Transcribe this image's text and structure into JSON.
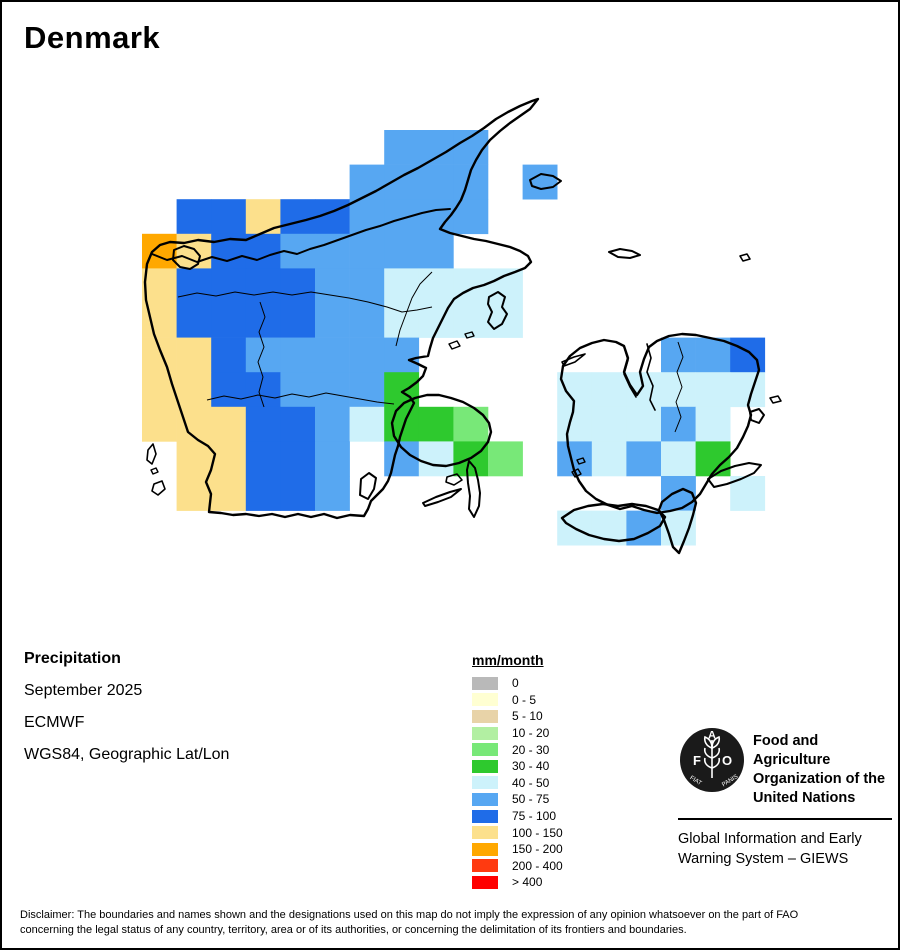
{
  "page": {
    "title": "Denmark"
  },
  "info": {
    "layer": "Precipitation",
    "period": "September 2025",
    "source": "ECMWF",
    "projection": "WGS84, Geographic Lat/Lon"
  },
  "legend": {
    "title": "mm/month",
    "items": [
      {
        "label": "0",
        "color": "#b9b9b9"
      },
      {
        "label": "0 - 5",
        "color": "#ffffd2"
      },
      {
        "label": "5 - 10",
        "color": "#e8d3a8"
      },
      {
        "label": "10 - 20",
        "color": "#b2efa2"
      },
      {
        "label": "20 - 30",
        "color": "#78e878"
      },
      {
        "label": "30 - 40",
        "color": "#2ec92e"
      },
      {
        "label": "40 - 50",
        "color": "#cdf2fb"
      },
      {
        "label": "50 - 75",
        "color": "#57a7f2"
      },
      {
        "label": "75 - 100",
        "color": "#1f6ce8"
      },
      {
        "label": "100 - 150",
        "color": "#fce08c"
      },
      {
        "label": "150 - 200",
        "color": "#ffa800"
      },
      {
        "label": "200 - 400",
        "color": "#ff3a10"
      },
      {
        "label": "> 400",
        "color": "#ff0000"
      }
    ]
  },
  "chart_data": {
    "type": "heatmap",
    "title": "Denmark precipitation, September 2025 (ECMWF), mm/month",
    "note": "grid cells: [col,row,value-class]; cell origin x0,y0 px, square cells"
  },
  "map": {
    "grid": {
      "x0": 140,
      "y0": 128,
      "cell": 34.6,
      "cells": [
        [
          7,
          0,
          "50 - 75"
        ],
        [
          8,
          0,
          "50 - 75"
        ],
        [
          9,
          0,
          "50 - 75"
        ],
        [
          6,
          1,
          "50 - 75"
        ],
        [
          7,
          1,
          "50 - 75"
        ],
        [
          8,
          1,
          "50 - 75"
        ],
        [
          9,
          1,
          "50 - 75"
        ],
        [
          11,
          1,
          "50 - 75"
        ],
        [
          1,
          2,
          "75 - 100"
        ],
        [
          2,
          2,
          "75 - 100"
        ],
        [
          3,
          2,
          "100 - 150"
        ],
        [
          4,
          2,
          "75 - 100"
        ],
        [
          5,
          2,
          "75 - 100"
        ],
        [
          6,
          2,
          "50 - 75"
        ],
        [
          7,
          2,
          "50 - 75"
        ],
        [
          8,
          2,
          "50 - 75"
        ],
        [
          9,
          2,
          "50 - 75"
        ],
        [
          0,
          3,
          "150 - 200"
        ],
        [
          1,
          3,
          "100 - 150"
        ],
        [
          2,
          3,
          "75 - 100"
        ],
        [
          3,
          3,
          "75 - 100"
        ],
        [
          4,
          3,
          "50 - 75"
        ],
        [
          5,
          3,
          "50 - 75"
        ],
        [
          6,
          3,
          "50 - 75"
        ],
        [
          7,
          3,
          "50 - 75"
        ],
        [
          8,
          3,
          "50 - 75"
        ],
        [
          0,
          4,
          "100 - 150"
        ],
        [
          1,
          4,
          "75 - 100"
        ],
        [
          2,
          4,
          "75 - 100"
        ],
        [
          3,
          4,
          "75 - 100"
        ],
        [
          4,
          4,
          "75 - 100"
        ],
        [
          5,
          4,
          "50 - 75"
        ],
        [
          6,
          4,
          "50 - 75"
        ],
        [
          7,
          4,
          "40 - 50"
        ],
        [
          8,
          4,
          "40 - 50"
        ],
        [
          9,
          4,
          "40 - 50"
        ],
        [
          10,
          4,
          "40 - 50"
        ],
        [
          0,
          5,
          "100 - 150"
        ],
        [
          1,
          5,
          "75 - 100"
        ],
        [
          2,
          5,
          "75 - 100"
        ],
        [
          3,
          5,
          "75 - 100"
        ],
        [
          4,
          5,
          "75 - 100"
        ],
        [
          5,
          5,
          "50 - 75"
        ],
        [
          6,
          5,
          "50 - 75"
        ],
        [
          7,
          5,
          "40 - 50"
        ],
        [
          8,
          5,
          "40 - 50"
        ],
        [
          9,
          5,
          "40 - 50"
        ],
        [
          10,
          5,
          "40 - 50"
        ],
        [
          0,
          6,
          "100 - 150"
        ],
        [
          1,
          6,
          "100 - 150"
        ],
        [
          2,
          6,
          "75 - 100"
        ],
        [
          3,
          6,
          "50 - 75"
        ],
        [
          4,
          6,
          "50 - 75"
        ],
        [
          5,
          6,
          "50 - 75"
        ],
        [
          6,
          6,
          "50 - 75"
        ],
        [
          7,
          6,
          "50 - 75"
        ],
        [
          15,
          6,
          "50 - 75"
        ],
        [
          16,
          6,
          "50 - 75"
        ],
        [
          17,
          6,
          "75 - 100"
        ],
        [
          0,
          7,
          "100 - 150"
        ],
        [
          1,
          7,
          "100 - 150"
        ],
        [
          2,
          7,
          "75 - 100"
        ],
        [
          3,
          7,
          "75 - 100"
        ],
        [
          4,
          7,
          "50 - 75"
        ],
        [
          5,
          7,
          "50 - 75"
        ],
        [
          6,
          7,
          "50 - 75"
        ],
        [
          7,
          7,
          "30 - 40"
        ],
        [
          12,
          7,
          "40 - 50"
        ],
        [
          13,
          7,
          "40 - 50"
        ],
        [
          14,
          7,
          "40 - 50"
        ],
        [
          15,
          7,
          "40 - 50"
        ],
        [
          16,
          7,
          "40 - 50"
        ],
        [
          17,
          7,
          "40 - 50"
        ],
        [
          0,
          8,
          "100 - 150"
        ],
        [
          1,
          8,
          "100 - 150"
        ],
        [
          2,
          8,
          "100 - 150"
        ],
        [
          3,
          8,
          "75 - 100"
        ],
        [
          4,
          8,
          "75 - 100"
        ],
        [
          5,
          8,
          "50 - 75"
        ],
        [
          6,
          8,
          "40 - 50"
        ],
        [
          7,
          8,
          "30 - 40"
        ],
        [
          8,
          8,
          "30 - 40"
        ],
        [
          9,
          8,
          "20 - 30"
        ],
        [
          12,
          8,
          "40 - 50"
        ],
        [
          13,
          8,
          "40 - 50"
        ],
        [
          14,
          8,
          "40 - 50"
        ],
        [
          15,
          8,
          "50 - 75"
        ],
        [
          16,
          8,
          "40 - 50"
        ],
        [
          1,
          9,
          "100 - 150"
        ],
        [
          2,
          9,
          "100 - 150"
        ],
        [
          3,
          9,
          "75 - 100"
        ],
        [
          4,
          9,
          "75 - 100"
        ],
        [
          5,
          9,
          "50 - 75"
        ],
        [
          7,
          9,
          "50 - 75"
        ],
        [
          8,
          9,
          "40 - 50"
        ],
        [
          9,
          9,
          "30 - 40"
        ],
        [
          10,
          9,
          "20 - 30"
        ],
        [
          12,
          9,
          "50 - 75"
        ],
        [
          13,
          9,
          "40 - 50"
        ],
        [
          14,
          9,
          "50 - 75"
        ],
        [
          15,
          9,
          "40 - 50"
        ],
        [
          16,
          9,
          "30 - 40"
        ],
        [
          1,
          10,
          "100 - 150"
        ],
        [
          2,
          10,
          "100 - 150"
        ],
        [
          3,
          10,
          "75 - 100"
        ],
        [
          4,
          10,
          "75 - 100"
        ],
        [
          5,
          10,
          "50 - 75"
        ],
        [
          15,
          10,
          "50 - 75"
        ],
        [
          17,
          10,
          "40 - 50"
        ],
        [
          12,
          11,
          "40 - 50"
        ],
        [
          13,
          11,
          "40 - 50"
        ],
        [
          14,
          11,
          "50 - 75"
        ],
        [
          15,
          11,
          "40 - 50"
        ]
      ]
    }
  },
  "footer": {
    "logo_text_f": "F",
    "logo_text_a": "A",
    "logo_text_o": "O",
    "logo_motto_left": "FIAT",
    "logo_motto_right": "PANIS",
    "org_lines": [
      "Food and Agriculture",
      "Organization of the",
      "United Nations"
    ],
    "giews_lines": [
      "Global Information and Early",
      "Warning System – GIEWS"
    ],
    "disclaimer_lines": [
      "Disclaimer: The boundaries and names shown and the designations used on this map do not imply the expression of any opinion whatsoever on the part of FAO",
      "concerning the legal status of any country, territory, area or of its authorities, or concerning the delimitation of its frontiers and boundaries."
    ]
  }
}
